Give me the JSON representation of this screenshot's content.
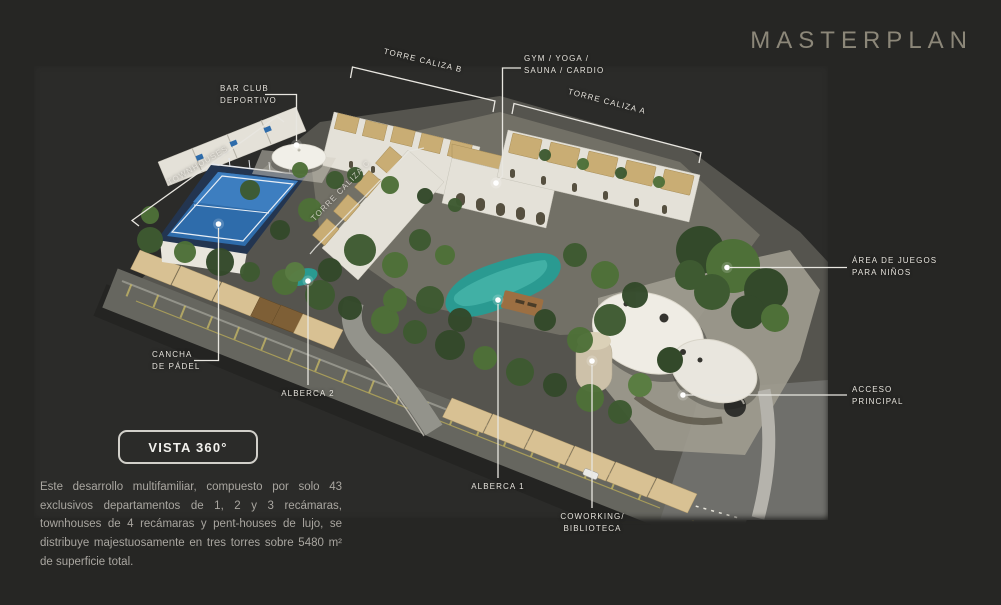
{
  "title": "MASTERPLAN",
  "vista_button": {
    "label": "VISTA 360°"
  },
  "description": "Este desarrollo multifamiliar, compuesto por solo 43 exclusivos departamentos de 1, 2 y 3 recámaras, townhouses de 4 recámaras y pent-houses de lujo, se distribuye majestuosamente en tres torres sobre 5480 m² de superficie total.",
  "callouts": {
    "torre_caliza_b": "TORRE CALIZA B",
    "gym": "GYM / YOGA /\nSAUNA / CARDIO",
    "torre_caliza_a": "TORRE CALIZA A",
    "bar_club": "BAR CLUB\nDEPORTIVO",
    "townhouses": "TOWNHOUSES",
    "torre_caliza_c": "TORRE CALIZA C",
    "cancha_padel": "CANCHA\nDE PÁDEL",
    "alberca_2": "ALBERCA 2",
    "alberca_1": "ALBERCA 1",
    "coworking": "COWORKING/\nBIBLIOTECA",
    "area_juegos": "ÁREA DE JUEGOS\nPARA NIÑOS",
    "acceso_principal": "ACCESO\nPRINCIPAL"
  },
  "colors": {
    "background": "#262624",
    "title_text": "#8c8779",
    "label_text": "#e6e3dc",
    "callout_line": "#e8e6e0",
    "button_border": "#d2d0ca",
    "description_text": "#a9a6a0",
    "pool_water": "#2a9a91",
    "padel_court": "#2e6cab",
    "carport_canopy": "#d8c193",
    "roof_tan": "#c9ad74",
    "building_white": "#e4e1d8",
    "greenery": "#4e7038",
    "road": "#66665f"
  }
}
